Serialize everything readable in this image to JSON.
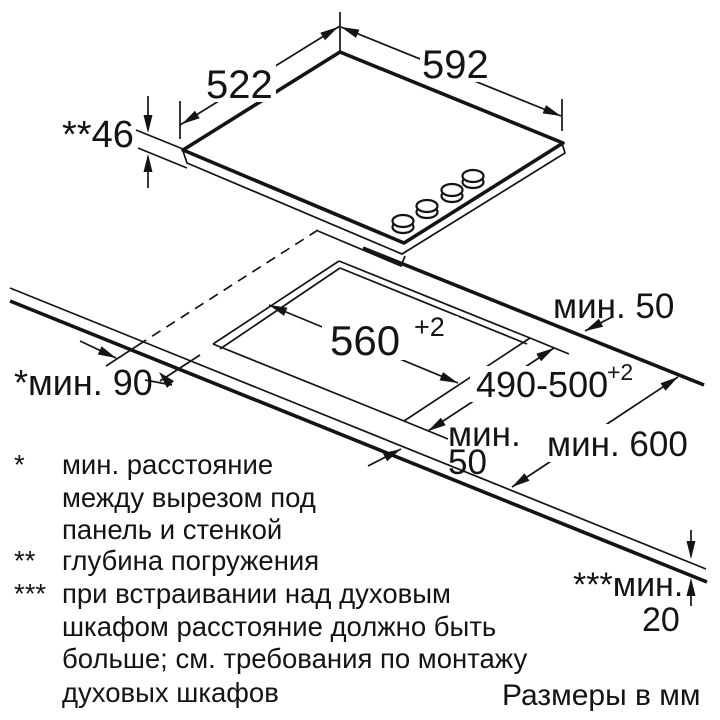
{
  "dims": {
    "top_width_left": "522",
    "top_width_right": "592",
    "immersion_depth": "**46",
    "cutout_width": "560",
    "cutout_width_tol": "+2",
    "cutout_depth": "490-500",
    "cutout_depth_tol": "+2",
    "min_front": "мин. 50",
    "min_front2_line1": "мин.",
    "min_front2_line2": "50",
    "min_wall": "*мин. 90",
    "min_counter_depth": "мин. 600",
    "min_oven_gap_label": "***мин.",
    "min_oven_gap_value": "20"
  },
  "footnotes": [
    {
      "marker": "*",
      "lines": [
        "мин. расстояние",
        "между вырезом под",
        "панель и стенкой"
      ]
    },
    {
      "marker": "**",
      "lines": [
        "глубина погружения"
      ]
    },
    {
      "marker": "***",
      "lines": [
        "при встраивании над духовым",
        "шкафом расстояние должно быть",
        "больше; см. требования по монтажу",
        "духовых шкафов"
      ]
    }
  ],
  "units_note": "Размеры в мм"
}
